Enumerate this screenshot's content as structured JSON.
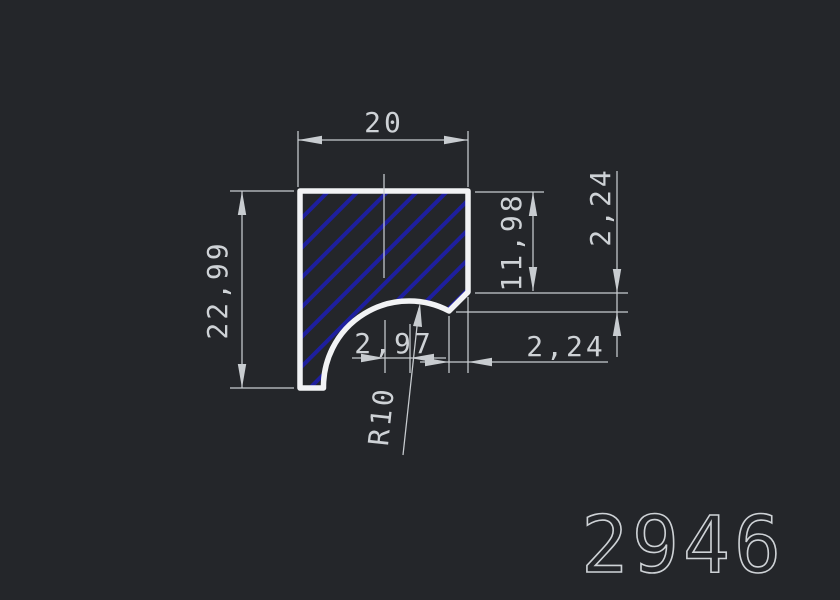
{
  "drawing": {
    "number": "2946",
    "dimensions": {
      "top_width": "20",
      "left_height": "22,99",
      "right_depth": "11,98",
      "right_step_vertical": "2,24",
      "arc_center_offset": "2,97",
      "step_horizontal": "2,24",
      "radius": "R10"
    },
    "colors": {
      "background": "#24262a",
      "hatch": "#1e1f9e",
      "outline": "#f2f3f5",
      "dimension_lines": "#c8ccd0",
      "text": "#ced2d6"
    }
  }
}
